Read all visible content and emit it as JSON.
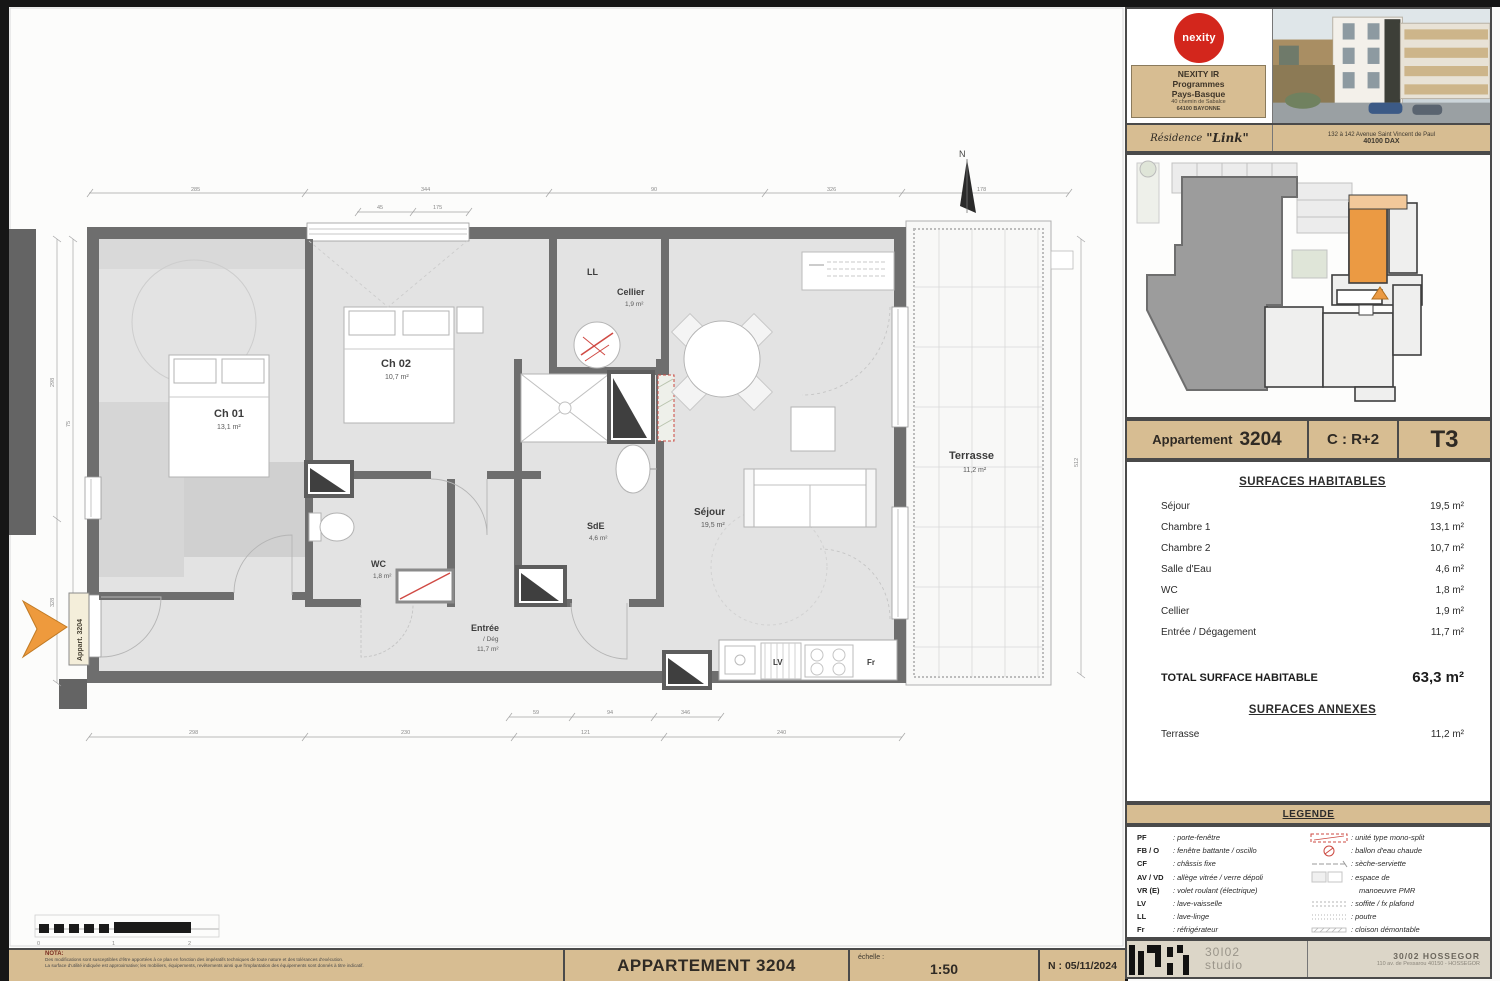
{
  "sheet": {
    "nota": {
      "title": "NOTA:",
      "line1": "Des modifications sont susceptibles d'être apportées à ce plan en fonction des impératifs techniques de toute nature et des tolérances d'exécution.",
      "line2": "La surface d'utilité indiquée est approximative; les mobiliers, équipements, revêtements ainsi que l'implantation des équipements sont donnés à titre indicatif."
    },
    "title_block": {
      "apartment_title": "APPARTEMENT 3204",
      "scale_label": "échelle :",
      "scale_value": "1:50",
      "date_value": "N : 05/11/2024"
    },
    "scale_bar": {
      "l0": "0",
      "l1": "1",
      "l2": "2"
    }
  },
  "plan": {
    "north_label": "N",
    "entry_marker": "Appart. 3204",
    "rooms": {
      "ch01": {
        "name": "Ch 01",
        "area": "13,1 m²"
      },
      "ch02": {
        "name": "Ch 02",
        "area": "10,7 m²"
      },
      "ll": {
        "name": "LL"
      },
      "cellier": {
        "name": "Cellier",
        "area": "1,9 m²"
      },
      "sde": {
        "name": "SdE",
        "area": "4,6 m²"
      },
      "wc": {
        "name": "WC",
        "area": "1,8 m²"
      },
      "sejour": {
        "name": "Séjour",
        "area": "19,5 m²"
      },
      "entree": {
        "name": "Entrée",
        "sub": "/ Dég",
        "area": "11,7 m²"
      },
      "terrasse": {
        "name": "Terrasse",
        "area": "11,2 m²"
      },
      "lv": "LV",
      "fr": "Fr"
    },
    "dims": {
      "t1": "285",
      "t2": "344",
      "t3": "90",
      "t4": "326",
      "t5": "178",
      "w1": "45",
      "w2": "175",
      "b1": "298",
      "b2": "230",
      "b3": "121",
      "b4": "59",
      "b5": "94",
      "b6": "346",
      "b7": "240",
      "l1": "298",
      "l2": "328",
      "l3": "75",
      "r1": "512"
    }
  },
  "sidebar": {
    "header": {
      "logo_text": "nexity",
      "company": "NEXITY IR",
      "line2": "Programmes",
      "line3": "Pays-Basque",
      "address1": "40 chemin de Sabalce",
      "address2": "64100 BAYONNE",
      "residence_label": "Résidence",
      "residence_name": "\"Link\"",
      "residence_address1": "132 à 142 Avenue Saint Vincent de Paul",
      "residence_address2": "40100 DAX"
    },
    "apartment_bar": {
      "name_label": "Appartement",
      "number": "3204",
      "level": "C : R+2",
      "type": "T3"
    },
    "surfaces": {
      "title": "SURFACES HABITABLES",
      "rows": [
        [
          "Séjour",
          "19,5 m²"
        ],
        [
          "Chambre 1",
          "13,1 m²"
        ],
        [
          "Chambre 2",
          "10,7 m²"
        ],
        [
          "Salle d'Eau",
          "4,6 m²"
        ],
        [
          "WC",
          "1,8 m²"
        ],
        [
          "Cellier",
          "1,9 m²"
        ],
        [
          "Entrée / Dégagement",
          "11,7 m²"
        ]
      ],
      "total_label": "TOTAL SURFACE HABITABLE",
      "total_value": "63,3 m²",
      "annexes_title": "SURFACES ANNEXES",
      "annex_rows": [
        [
          "Terrasse",
          "11,2 m²"
        ]
      ]
    },
    "legend": {
      "title": "LEGENDE",
      "left": [
        [
          "PF",
          "porte-fenêtre"
        ],
        [
          "FB / O",
          "fenêtre battante / oscillo"
        ],
        [
          "CF",
          "châssis fixe"
        ],
        [
          "AV / VD",
          "allège vitrée / verre dépoli"
        ],
        [
          "VR (E)",
          "volet roulant (électrique)"
        ],
        [
          "LV",
          "lave-vaisselle"
        ],
        [
          "LL",
          "lave-linge"
        ],
        [
          "Fr",
          "réfrigérateur"
        ]
      ],
      "right": [
        [
          "unité type mono-split"
        ],
        [
          "ballon d'eau chaude"
        ],
        [
          "sèche-serviette"
        ],
        [
          "espace de"
        ],
        [
          "manoeuvre PMR"
        ],
        [
          "soffite / fx plafond"
        ],
        [
          "poutre"
        ],
        [
          "cloison démontable"
        ]
      ]
    },
    "footer": {
      "studio_top": "30I02",
      "studio_bottom": "studio",
      "office": "30/02 HOSSEGOR",
      "office_address": "110 av. de Pessarou  40150 - HOSSEGOR"
    }
  }
}
